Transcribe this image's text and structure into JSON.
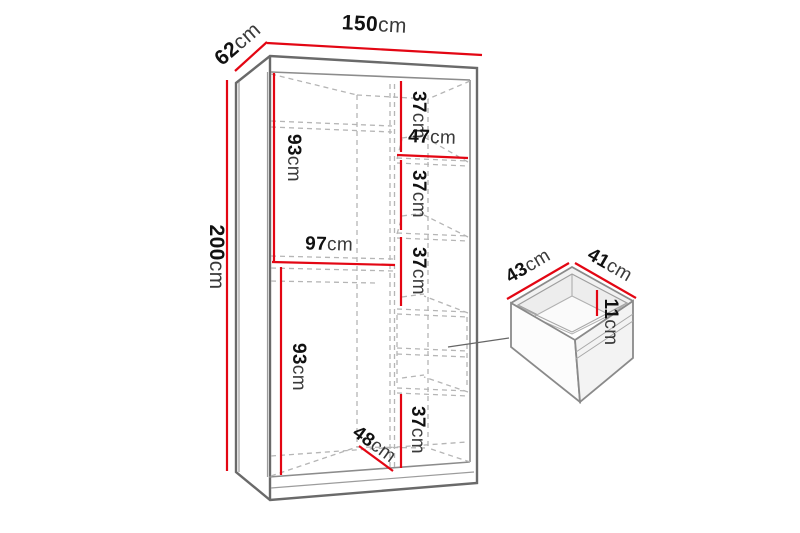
{
  "meta": {
    "description": "Dimension diagram of a two-section sliding-door wardrobe with detail view of a drawer",
    "unit": "cm"
  },
  "colors": {
    "dimension_line": "#e30613",
    "outline": "#6a6a6a",
    "hidden_line": "#b5b5b5",
    "number_text": "#111111",
    "unit_text": "#3a3a3a",
    "background": "#ffffff"
  },
  "wardrobe": {
    "width": {
      "value": "150",
      "unit": "cm"
    },
    "depth": {
      "value": "62",
      "unit": "cm"
    },
    "height": {
      "value": "200",
      "unit": "cm"
    },
    "left_column": {
      "upper_height": {
        "value": "93",
        "unit": "cm"
      },
      "width": {
        "value": "97",
        "unit": "cm"
      },
      "lower_height": {
        "value": "93",
        "unit": "cm"
      }
    },
    "right_column": {
      "width": {
        "value": "47",
        "unit": "cm"
      },
      "gap_1": {
        "value": "37",
        "unit": "cm"
      },
      "gap_2": {
        "value": "37",
        "unit": "cm"
      },
      "gap_3": {
        "value": "37",
        "unit": "cm"
      },
      "gap_4": {
        "value": "37",
        "unit": "cm"
      }
    },
    "interior_depth": {
      "value": "48",
      "unit": "cm"
    }
  },
  "drawer_detail": {
    "width": {
      "value": "43",
      "unit": "cm"
    },
    "depth": {
      "value": "41",
      "unit": "cm"
    },
    "inner_height": {
      "value": "11",
      "unit": "cm"
    }
  }
}
